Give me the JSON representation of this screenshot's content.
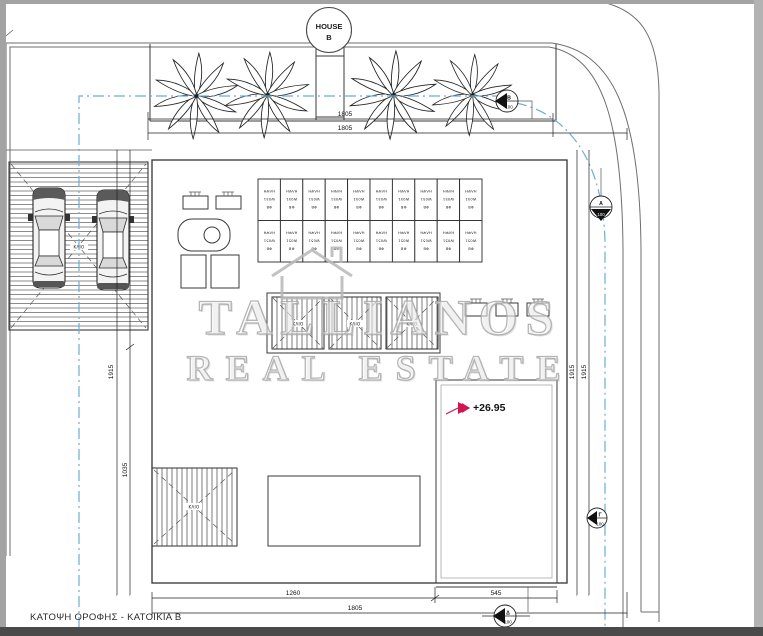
{
  "header_badge": {
    "line1": "HOUSE",
    "line2": "B"
  },
  "watermark": {
    "line1": "TALLIANOS",
    "line2": "REAL ESTATE"
  },
  "drawing_title": "ΚΑΤΟΨΗ ΟΡΟΦΗΣ - ΚΑΤΟΙΚΙΑ Β",
  "elevation_label": "+26.95",
  "dimensions": {
    "top": [
      {
        "label": "1805"
      },
      {
        "label": "1805"
      }
    ],
    "bottom": [
      {
        "label": "1260"
      },
      {
        "label": "545"
      },
      {
        "label": "1805"
      }
    ],
    "left": [
      {
        "label": "1915"
      },
      {
        "label": "1035"
      }
    ],
    "right": [
      {
        "label": "1915"
      },
      {
        "label": "1915"
      }
    ]
  },
  "section_markers": [
    {
      "letter": "B",
      "scale": "100"
    },
    {
      "letter": "A",
      "scale": "100"
    },
    {
      "letter": "Γ",
      "scale": "100"
    },
    {
      "letter": "Δ",
      "scale": "100"
    }
  ],
  "solar_panels": {
    "rows": 2,
    "cols": 10,
    "label_lines": [
      "ΦΒ",
      "W051",
      "ΗΛΨΗ"
    ]
  },
  "labels": {
    "pergola": "ΚΛΙΟ"
  },
  "colors": {
    "line": "#3a3a3a",
    "boundary_blue": "#6aaed6",
    "elevation_red": "#d0164e",
    "watermark_gray": "#bdbdbd",
    "frame_gray": "#a3a3a3",
    "bottom_bar": "#4a4a4a"
  }
}
